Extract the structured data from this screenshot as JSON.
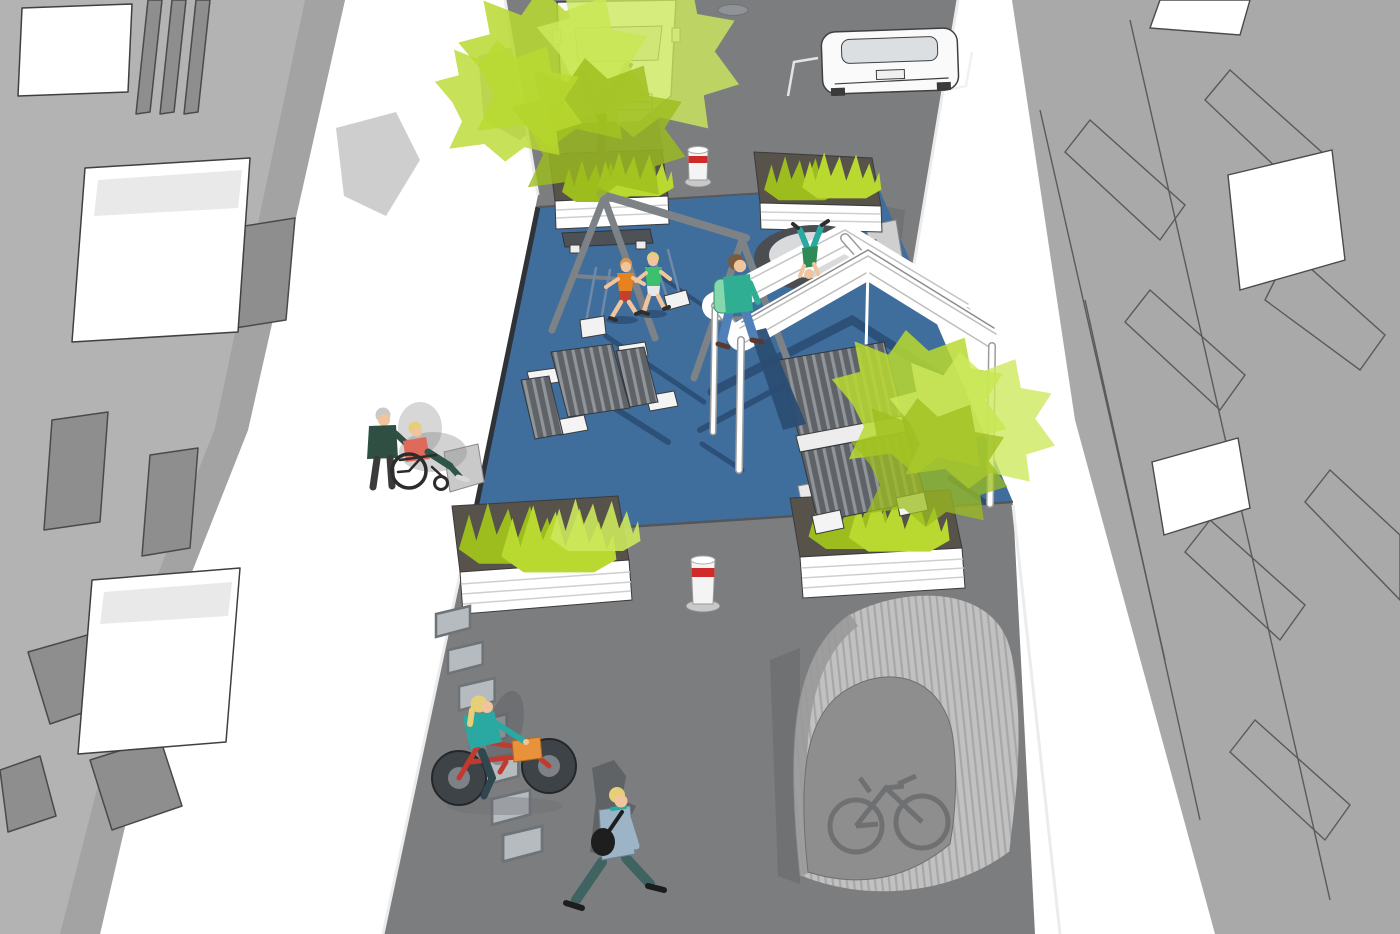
{
  "scene": {
    "type": "3d-street-redesign-rendering",
    "objects": [
      {
        "id": "apartment-building-left",
        "label": "apartment building (left)"
      },
      {
        "id": "apartment-building-right",
        "label": "apartment building (right)"
      },
      {
        "id": "sidewalk",
        "label": "white sidewalks"
      },
      {
        "id": "street",
        "label": "asphalt street"
      },
      {
        "id": "play-surface",
        "label": "blue painted play-street platform"
      },
      {
        "id": "swing-set",
        "label": "A-frame swing set with two swings"
      },
      {
        "id": "picnic-table",
        "label": "picnic table with two benches"
      },
      {
        "id": "trampoline",
        "label": "in-ground trampoline"
      },
      {
        "id": "pergola",
        "label": "white pergola with slatted benches"
      },
      {
        "id": "planters",
        "label": "four white planters with shrubs",
        "count": 4
      },
      {
        "id": "street-trees",
        "label": "lime-green street trees",
        "count": 2
      },
      {
        "id": "bollards",
        "label": "retractable bollards with red band",
        "count": 2
      },
      {
        "id": "parked-truck",
        "label": "white van parked top left"
      },
      {
        "id": "parked-car",
        "label": "white car parked top right"
      },
      {
        "id": "bike-racks",
        "label": "row of bicycle stands",
        "count": 7
      },
      {
        "id": "bike-shelter",
        "label": "arched corrugated bike shelter with bicycle icon"
      },
      {
        "id": "cyclist",
        "label": "woman riding red bicycle with orange basket"
      },
      {
        "id": "pedestrian-bag",
        "label": "man walking with shoulder bag"
      },
      {
        "id": "children-running",
        "label": "two children running on play surface",
        "count": 2
      },
      {
        "id": "walker-backpack",
        "label": "person walking with mint backpack"
      },
      {
        "id": "handstand-child",
        "label": "child doing handstand on trampoline"
      },
      {
        "id": "wheelchair-pair",
        "label": "person pushing wheelchair user on sidewalk"
      }
    ],
    "icons": {
      "bicycle-icon": "bicycle glyph on bike shelter front"
    }
  },
  "palette": {
    "sidewalk": "#ffffff",
    "street": "#7c7d7f",
    "play_surface": "#3f6e9d",
    "play_shadow": "#2b4d74",
    "building_left": "#b3b3b3",
    "building_left_band": "#a3a3a3",
    "building_left_window": "#8e8e8e",
    "building_right": "#a9a9a9",
    "outline": "#3f3f3f",
    "foliage": "#b9d930",
    "foliage_light": "#cde85d",
    "foliage_dark": "#9cbd1d",
    "trunk": "#56514a",
    "soil": "#57534a",
    "planter_white": "#ffffff",
    "equipment_gray": "#7d8287",
    "bench_dark": "#4e5257",
    "bollard_white": "#f4f4f4",
    "bollard_red": "#cf2b28",
    "shelter_face": "#8e8e8e",
    "shelter_glyph": "#6e7071",
    "shadow_gray": "#5e6164",
    "bike_red": "#c23a2f",
    "basket_orange": "#e8923c",
    "teal": "#2aa8a2",
    "teal_green": "#2fae93",
    "jeans": "#4f81b8",
    "mint": "#86d6ae",
    "shirt_green": "#3cc06d",
    "shirt_orange": "#e8821e",
    "shorts_red": "#c4402e",
    "coral": "#df6a5b",
    "sweater_green": "#2e4f42",
    "pants_teal": "#3f6360",
    "jacket_blue": "#9db4c6",
    "skin": "#f0c49c",
    "hair_blonde": "#e6cf77",
    "hair_gray": "#c9c9c9",
    "hair_brown": "#7a5b3e",
    "vehicle_white": "#fafafa"
  }
}
